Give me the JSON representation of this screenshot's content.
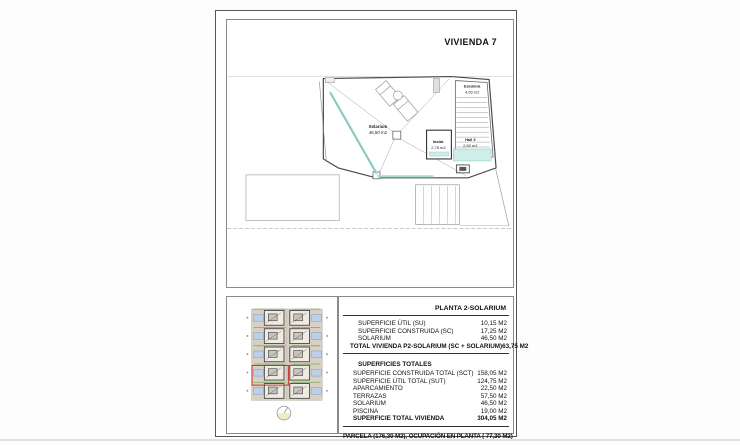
{
  "page": {
    "title": "VIVIENDA 7"
  },
  "floor_plan": {
    "solarium": {
      "name": "Solarium",
      "area": "46,50 m2"
    },
    "escalera": {
      "name": "Escalera",
      "area": "4,50 m2"
    },
    "instal": {
      "name": "Instal.",
      "area": "2,75 m2"
    },
    "hall": {
      "name": "Hall 3",
      "area": "2,50 m2"
    }
  },
  "site_plan": {
    "rows": 5,
    "columns": 2,
    "highlighted_unit": "row-4-left"
  },
  "summary_table": {
    "header": "PLANTA 2-SOLARIUM",
    "planta_rows": [
      {
        "label": "SUPERFICIE ÚTIL (SU)",
        "value": "10,15 M2",
        "bold": false
      },
      {
        "label": "SUPERFICIE CONSTRUIDA (SC)",
        "value": "17,25 M2",
        "bold": false
      },
      {
        "label": "SOLARIUM",
        "value": "46,50 M2",
        "bold": false
      },
      {
        "label": "TOTAL VIVIENDA P2-SOLARIUM (SC + SOLARIUM)",
        "value": "63,75 M2",
        "bold": true
      }
    ],
    "totals_title": "SUPERFICIES TOTALES",
    "totals_rows": [
      {
        "label": "SUPERFICIE CONSTRUIDA TOTAL (SCT)",
        "value": "158,05 M2",
        "bold": false
      },
      {
        "label": "SUPERFICIE ÚTIL TOTAL (SUT)",
        "value": "124,75 M2",
        "bold": false
      },
      {
        "label": "APARCAMIENTO",
        "value": "22,50 M2",
        "bold": false
      },
      {
        "label": "TERRAZAS",
        "value": "57,50 M2",
        "bold": false
      },
      {
        "label": "SOLARIUM",
        "value": "46,50 M2",
        "bold": false
      },
      {
        "label": "PISCINA",
        "value": "19,00 M2",
        "bold": false
      },
      {
        "label": "SUPERFICIE TOTAL VIVIENDA",
        "value": "304,05 M2",
        "bold": true
      }
    ],
    "footer": "PARCELA  (176,30 M2), OCUPACIÓN EN PLANTA ( 77,30 M2)"
  },
  "colors": {
    "accent_teal": "#a8dcd4",
    "accent_teal_dark": "#57ab9f",
    "hall_fill": "#cfeeea",
    "highlight_red": "#c0392b",
    "pool_blue": "#b9d0e8",
    "site_tan": "#d9cfc2",
    "hedge_green": "#86b06a",
    "compass_yellow": "#f2ecc0"
  }
}
